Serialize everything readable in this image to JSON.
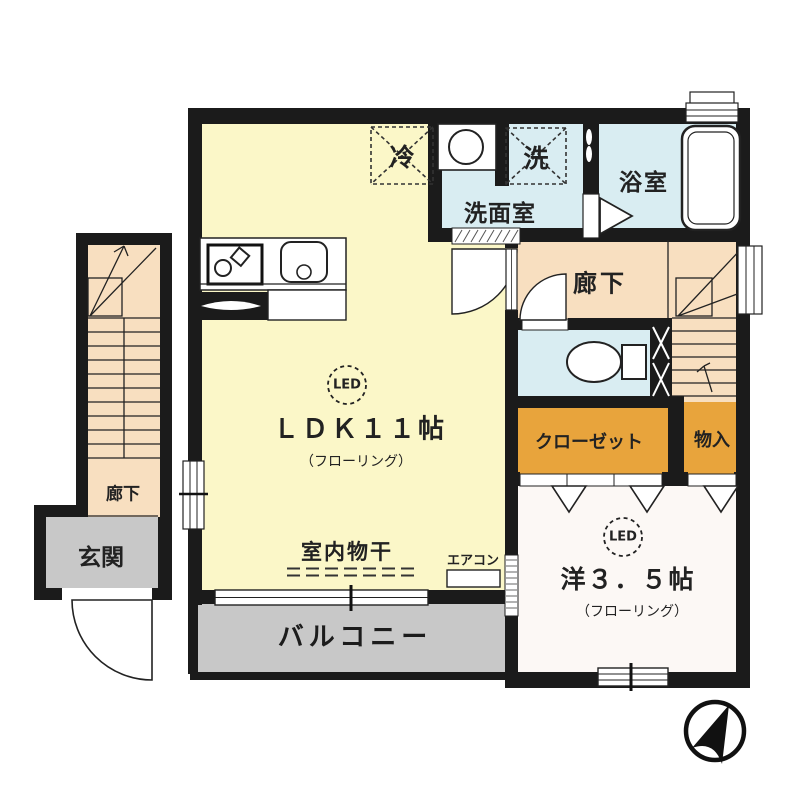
{
  "title": "間取り図 (floor plan)",
  "colors": {
    "wall": "#1b1b1b",
    "ldk": "#FBF7C8",
    "wet": "#D9EDF2",
    "corridor": "#F8DFC0",
    "closet": "#E8A43C",
    "balcony": "#C8C8C8",
    "western": "#FCF8F5"
  },
  "labels": {
    "fridge": "冷",
    "washer": "洗",
    "washroom": "洗面室",
    "bathroom": "浴室",
    "corridor_upper": "廊下",
    "corridor_left": "廊下",
    "closet": "クローゼット",
    "storage": "物入",
    "indoor_drying": "室内物干",
    "aircon": "エアコン",
    "balcony": "バルコニー",
    "genkan": "玄関",
    "ldk": {
      "led": "LED",
      "name": "ＬＤＫ１１帖",
      "sub": "（フローリング）"
    },
    "western": {
      "led": "LED",
      "name": "洋３．５帖",
      "sub": "（フローリング）"
    }
  }
}
